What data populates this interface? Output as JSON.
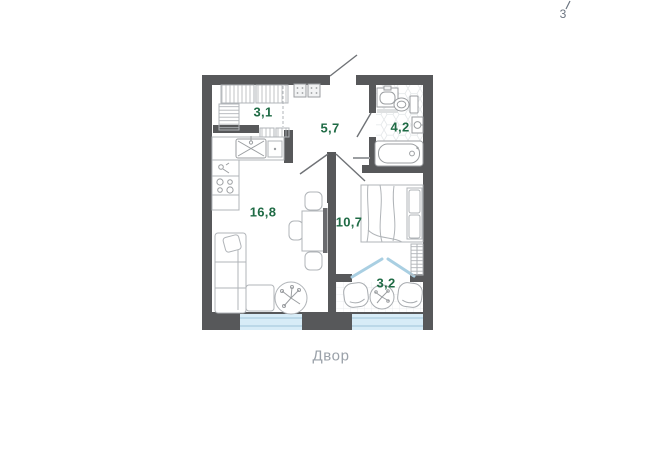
{
  "page": {
    "floor_indicator": "3",
    "courtyard_label": "Двор"
  },
  "rooms": [
    {
      "id": "wardrobe",
      "area": "3,1"
    },
    {
      "id": "hallway",
      "area": "5,7"
    },
    {
      "id": "bathroom",
      "area": "4,2"
    },
    {
      "id": "kitchen-living",
      "area": "16,8"
    },
    {
      "id": "bedroom",
      "area": "10,7"
    },
    {
      "id": "balcony",
      "area": "3,2"
    }
  ],
  "colors": {
    "wall": "#57585a",
    "room_label": "#1f6b45",
    "window_fill": "#d7ecf7",
    "window_line": "#9fc4d8",
    "glazing_line": "#a9cfe2",
    "furniture_line": "#b0b4b8",
    "fixture_line": "#9b9ea1",
    "muted_text": "#9aa1a9",
    "floor_text": "#6b7480"
  }
}
